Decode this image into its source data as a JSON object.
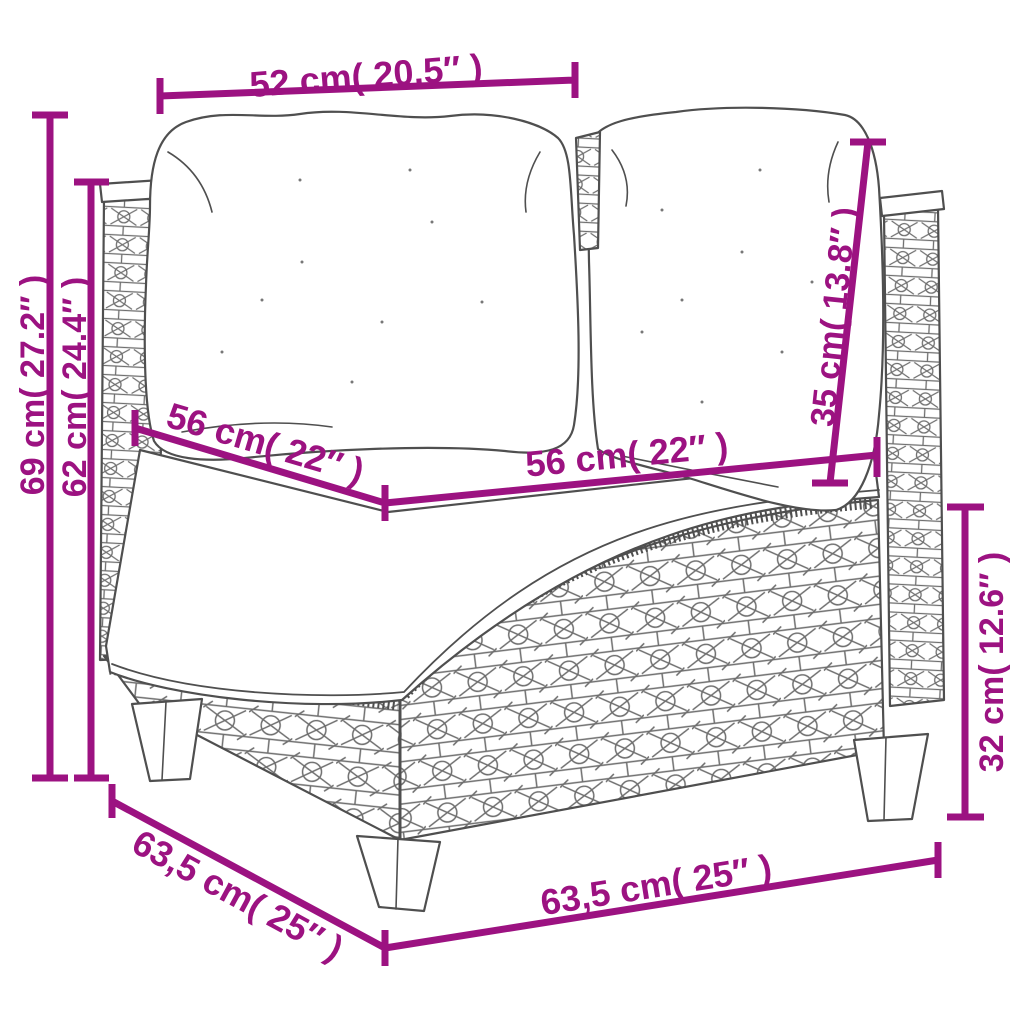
{
  "diagram": {
    "description": "Dimension diagram of a poly rattan corner sofa section with white cushions",
    "background": "#ffffff",
    "art_color": "#4f4f4f",
    "dim_color": "#9C1281"
  },
  "dims": {
    "top_width": "52 cm( 20.5″ )",
    "total_height": "69 cm( 27.2″ )",
    "frame_height": "62 cm( 24.4″ )",
    "seat_depth": "56 cm( 22″ )",
    "seat_width": "56 cm( 22″ )",
    "back_cushion_height": "35 cm( 13.8″ )",
    "base_height": "32 cm( 12.6″ )",
    "base_depth": "63,5 cm( 25″ )",
    "base_width": "63,5 cm( 25″ )"
  }
}
